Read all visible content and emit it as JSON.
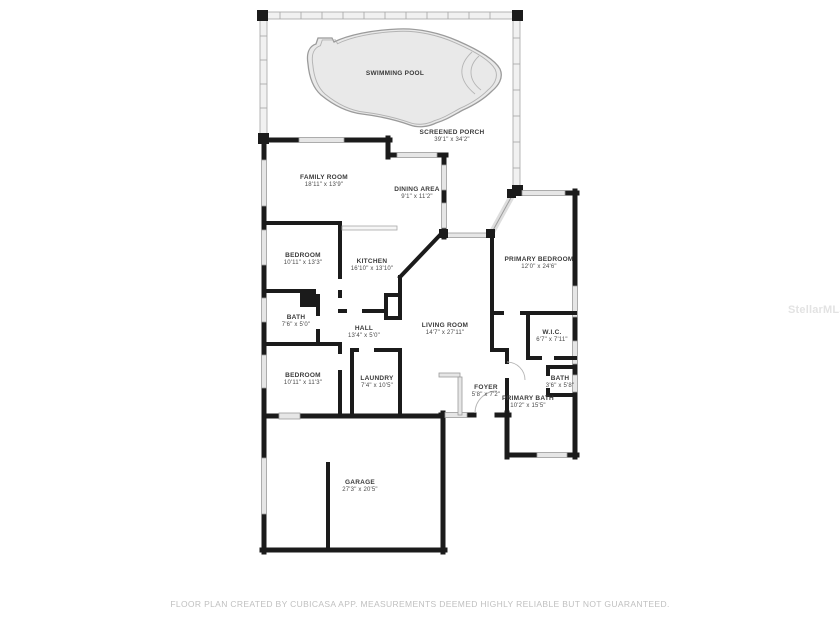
{
  "title": "Floor plan",
  "watermark": "StellarMLS",
  "footer": "FLOOR PLAN CREATED BY CUBICASA APP. MEASUREMENTS DEEMED HIGHLY RELIABLE BUT NOT GUARANTEED.",
  "colors": {
    "wall": "#1b1b1b",
    "pool_fill": "#e9e9e9",
    "pool_outline": "#9b9b9b",
    "porch_wall": "#a5a5a5",
    "window_fill": "#e6e6e6",
    "label_text": "#3a3a3a",
    "footer_text": "#c0c0c0",
    "watermark_text": "#e3e3e3"
  },
  "rooms": [
    {
      "id": "swimming-pool",
      "name": "SWIMMING POOL",
      "dims": ""
    },
    {
      "id": "screened-porch",
      "name": "SCREENED PORCH",
      "dims": "39'1\" x 34'2\""
    },
    {
      "id": "family-room",
      "name": "FAMILY ROOM",
      "dims": "18'11\" x 13'9\""
    },
    {
      "id": "dining-area",
      "name": "DINING AREA",
      "dims": "9'1\" x 11'2\""
    },
    {
      "id": "bedroom-1",
      "name": "BEDROOM",
      "dims": "10'11\" x 13'3\""
    },
    {
      "id": "kitchen",
      "name": "KITCHEN",
      "dims": "16'10\" x 13'10\""
    },
    {
      "id": "primary-bedroom",
      "name": "PRIMARY BEDROOM",
      "dims": "12'0\" x 24'6\""
    },
    {
      "id": "bath-1",
      "name": "BATH",
      "dims": "7'6\" x 5'0\""
    },
    {
      "id": "hall",
      "name": "HALL",
      "dims": "13'4\" x 5'0\""
    },
    {
      "id": "living-room",
      "name": "LIVING ROOM",
      "dims": "14'7\" x 27'11\""
    },
    {
      "id": "wic",
      "name": "W.I.C.",
      "dims": "6'7\" x 7'11\""
    },
    {
      "id": "bedroom-2",
      "name": "BEDROOM",
      "dims": "10'11\" x 11'3\""
    },
    {
      "id": "laundry",
      "name": "LAUNDRY",
      "dims": "7'4\" x 10'5\""
    },
    {
      "id": "foyer",
      "name": "FOYER",
      "dims": "5'8\" x 7'2\""
    },
    {
      "id": "bath-2",
      "name": "BATH",
      "dims": "3'6\" x 5'8\""
    },
    {
      "id": "primary-bath",
      "name": "PRIMARY BATH",
      "dims": "10'2\" x 15'5\""
    },
    {
      "id": "garage",
      "name": "GARAGE",
      "dims": "27'3\" x 20'5\""
    }
  ]
}
